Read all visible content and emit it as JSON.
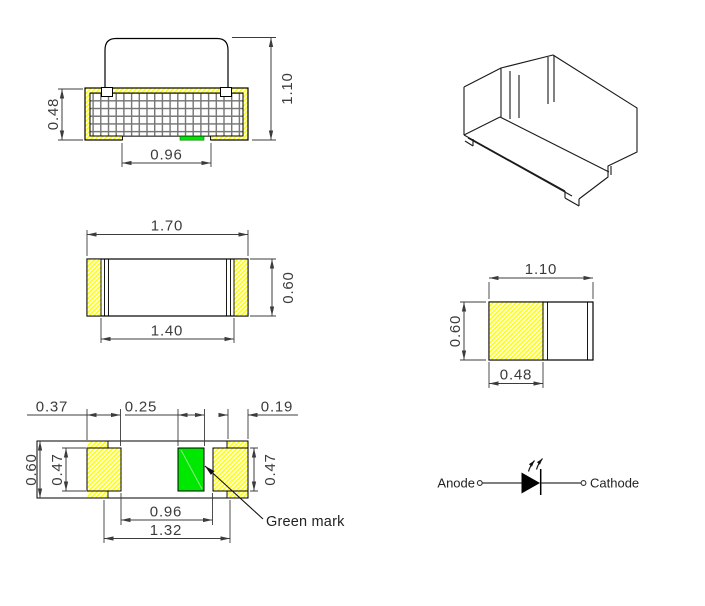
{
  "colors": {
    "pad_hatch_yellow": "#FFFF00",
    "green_mark": "#00E800",
    "outline_black": "#000000",
    "dimension_gray": "#3C3C3C"
  },
  "front_view": {
    "dim_base_height": "0.48",
    "dim_total_height": "1.10",
    "dim_bottom_width": "0.96"
  },
  "top_view": {
    "dim_total_width": "1.70",
    "dim_inner_width": "1.40",
    "dim_depth": "0.60"
  },
  "side_view": {
    "dim_total_width": "1.10",
    "dim_height": "0.60",
    "dim_terminal_width": "0.48"
  },
  "bottom_view": {
    "dim_pad_width": "0.37",
    "dim_green_mark_width": "0.25",
    "dim_edge_margin": "0.19",
    "dim_depth": "0.60",
    "dim_pad_depth_left": "0.47",
    "dim_pad_depth_right": "0.47",
    "dim_inner_span": "0.96",
    "dim_pad_span": "1.32",
    "green_mark_label": "Green mark"
  },
  "symbol": {
    "anode_label": "Anode",
    "cathode_label": "Cathode"
  }
}
